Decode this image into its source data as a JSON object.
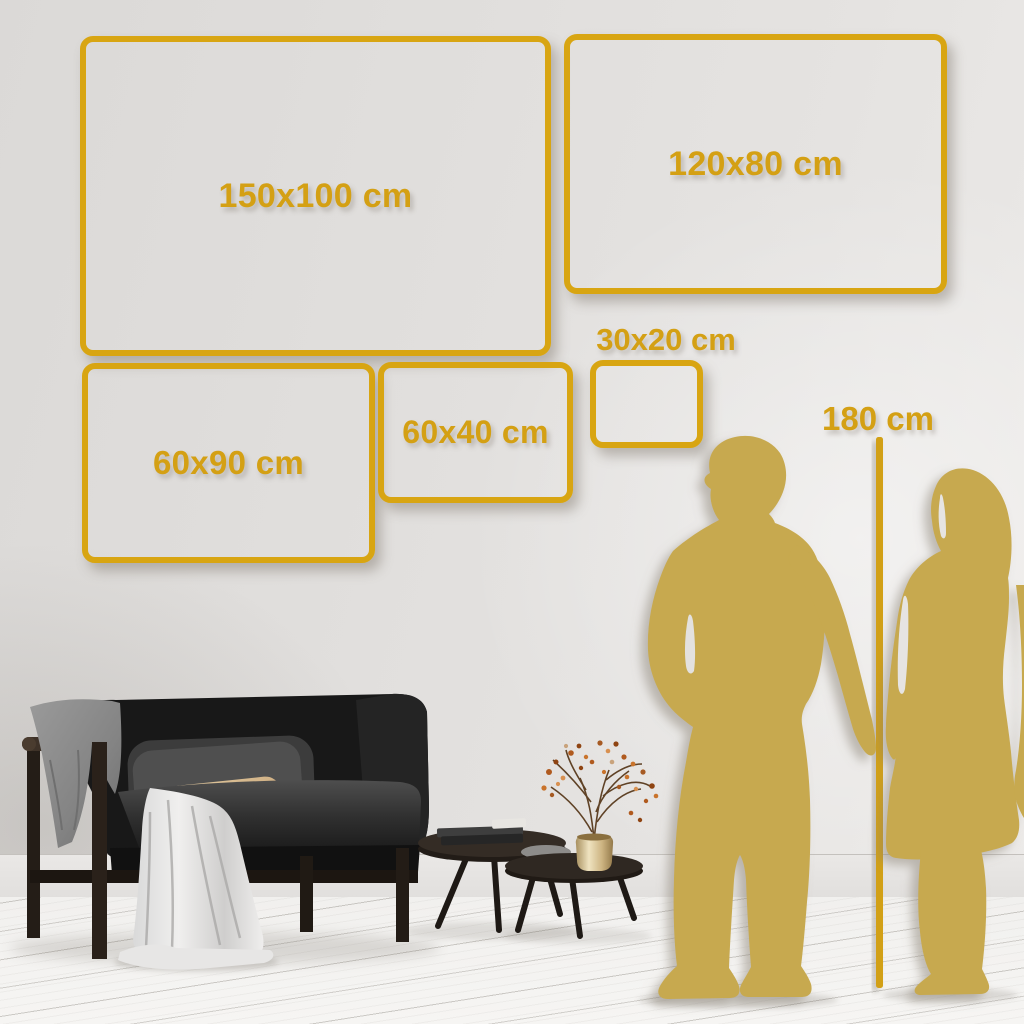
{
  "page": {
    "title": "Wall art size guide"
  },
  "size_guide": {
    "unit": "cm",
    "options": [
      {
        "id": "150x100",
        "label": "150x100 cm"
      },
      {
        "id": "120x80",
        "label": "120x80 cm"
      },
      {
        "id": "60x90",
        "label": "60x90 cm"
      },
      {
        "id": "60x40",
        "label": "60x40 cm"
      },
      {
        "id": "30x20",
        "label": "30x20 cm"
      }
    ],
    "height_reference": {
      "label": "180 cm"
    }
  },
  "colors": {
    "accent_gold": "#D8A512",
    "silhouette_gold": "#C7A94F",
    "wall": "#E0DEDC",
    "floor": "#F4F3F1",
    "sofa_charcoal": "#1B1B1B",
    "pillow_beige": "#D3B488",
    "blanket_gray": "#8C8C8C",
    "brass": "#CDB88C"
  },
  "scene": {
    "description": "Living room wall mockup with couple silhouette for scale",
    "items": [
      "sofa",
      "throw-blanket",
      "white-drape",
      "gray-pillow",
      "beige-pillow",
      "nesting-coffee-tables",
      "books",
      "brass-vase",
      "dried-branches",
      "man-silhouette",
      "woman-silhouette",
      "height-reference-line"
    ]
  }
}
